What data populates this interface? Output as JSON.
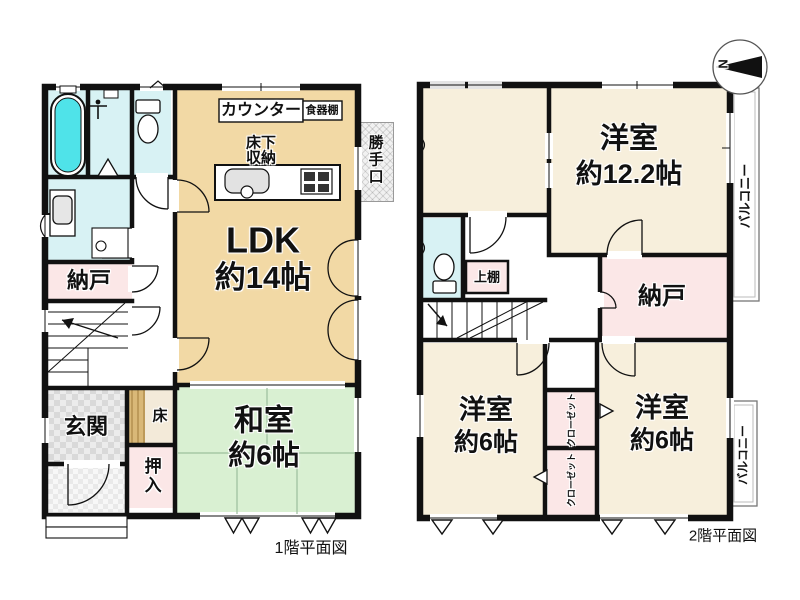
{
  "captions": {
    "floor1": "1階平面図",
    "floor2": "2階平面図"
  },
  "compass": {
    "north": "N"
  },
  "floor1": {
    "ldk": {
      "name": "LDK",
      "size": "約14帖"
    },
    "washitsu": {
      "name": "和室",
      "size": "約6帖"
    },
    "nando": "納戸",
    "genkan": "玄関",
    "oshiire": "押入",
    "toko": "床",
    "counter": "カウンター",
    "cupboard": "食器棚",
    "underfloor_storage": "床下収納",
    "back_door": "勝手口"
  },
  "floor2": {
    "room_large": {
      "name": "洋室",
      "size": "約12.2帖"
    },
    "room_left": {
      "name": "洋室",
      "size": "約6帖"
    },
    "room_right": {
      "name": "洋室",
      "size": "約6帖"
    },
    "nando": "納戸",
    "upper_shelf": "上棚",
    "closet_top": "クローゼット",
    "closet_bottom": "クローゼット",
    "balcony_top": "バルコニー",
    "balcony_bottom": "バルコニー"
  },
  "colors": {
    "wall": "#111111",
    "ldk": "#F2D9A5",
    "tatami": "#D9F0D2",
    "cream": "#F7EFDC",
    "pink": "#FBE7E7",
    "wet_area": "#D8F2F4",
    "bathtub": "#4FE3E9",
    "entrance_tile": "#ECECEC",
    "wood_step": "#D9B878"
  }
}
